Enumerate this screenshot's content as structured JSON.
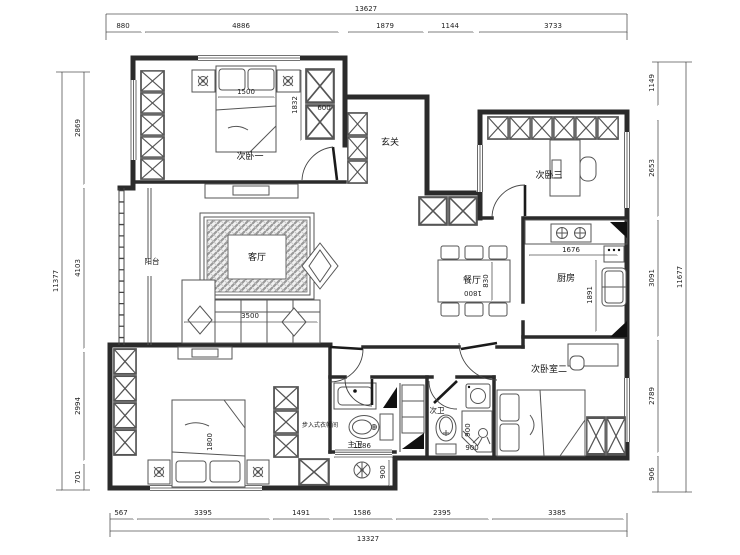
{
  "rooms": {
    "bedroom1": "次卧一",
    "entry": "玄关",
    "study": "次卧三",
    "living": "客厅",
    "balcony": "阳台",
    "dining": "餐厅",
    "kitchen": "厨房",
    "master_bath": "主卫",
    "second_bath": "次卫",
    "bedroom2": "次卧室二",
    "closet": "步入式衣帽间"
  },
  "dims": {
    "top": {
      "total": "13627",
      "segs": [
        "880",
        "4886",
        "1879",
        "1144",
        "3733"
      ]
    },
    "bottom": {
      "total": "13327",
      "segs": [
        "567",
        "3395",
        "1491",
        "1586",
        "2395",
        "3385"
      ]
    },
    "left": {
      "total": "11377",
      "segs": [
        "2869",
        "4103",
        "2994",
        "701"
      ]
    },
    "right": {
      "total": "11677",
      "segs": [
        "1149",
        "2653",
        "3091",
        "2789",
        "906"
      ]
    },
    "interior": {
      "bed1": "1500",
      "cabinet_height": "1832",
      "cabinet_depth": "600",
      "sofa": "3500",
      "dining_length": "1800",
      "dining_width": "830",
      "kitchen_width": "1676",
      "kitchen_depth": "1891",
      "master_bed": "1800",
      "bath_width": "1586",
      "bath_depth": "900",
      "shower_width": "900",
      "shower_depth": "900"
    }
  }
}
